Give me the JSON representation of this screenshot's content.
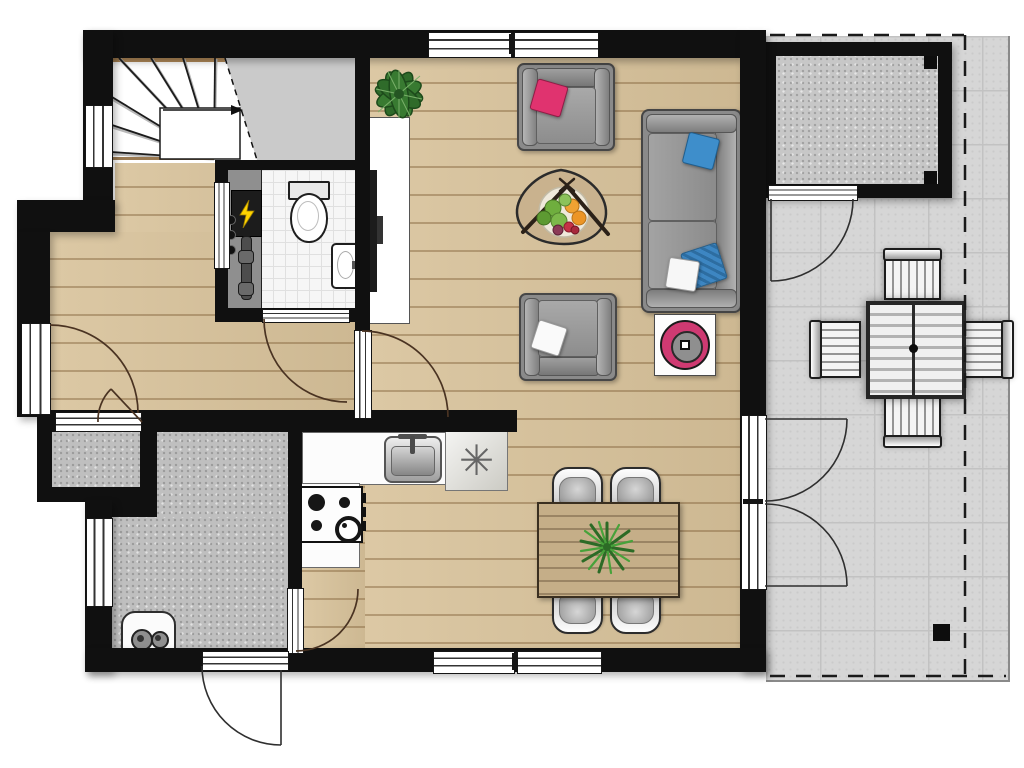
{
  "plan": {
    "type": "floor-plan",
    "floor": "ground-floor",
    "rooms": [
      "hallway",
      "staircase",
      "toilet",
      "meter-cupboard",
      "storage-closet",
      "utility-room",
      "kitchen",
      "dining-area",
      "living-room",
      "terrace",
      "garden-shed"
    ],
    "colors": {
      "wall": "#101010",
      "wood_floor": "#d8c29a",
      "terrace_tile": "#d6d6d6",
      "concrete_floor": "#bfbfbf",
      "toilet_tile": "#f6f6f6",
      "sofa_gray": "#8a8a8a",
      "cushion_pink": "#e0336f",
      "cushion_blue": "#3e8ecb",
      "plant_green": "#2f6b2a",
      "decor_ring_pink": "#cf3a72",
      "table_wood": "#c9b28e",
      "meter_bolt_yellow": "#ffd400"
    },
    "kitchen": {
      "fridge_symbol": "✳",
      "hob_burners": 4,
      "fixtures": [
        "sink",
        "hob",
        "fridge-freezer",
        "counter"
      ]
    },
    "dining": {
      "chairs": 4,
      "table_plant": "fern"
    },
    "living": {
      "armchairs": 2,
      "sofa_seats": 2,
      "decor": [
        "tv-cabinet",
        "plant",
        "coffee-table-with-fruit-bowl",
        "side-table-pink-bowl"
      ]
    },
    "terrace": {
      "chairs": 4,
      "table": "slatted-square",
      "boundary": "dashed-property-line"
    },
    "utility": {
      "appliances": [
        "washing-machine"
      ]
    },
    "toilet_room": {
      "fixtures": [
        "toilet",
        "corner-basin"
      ]
    },
    "meter_cupboard": {
      "fixtures": [
        "electric-panel",
        "fuses",
        "pipe"
      ]
    },
    "stairs": {
      "direction_arrow": "up-to-right",
      "type": "winder"
    }
  }
}
